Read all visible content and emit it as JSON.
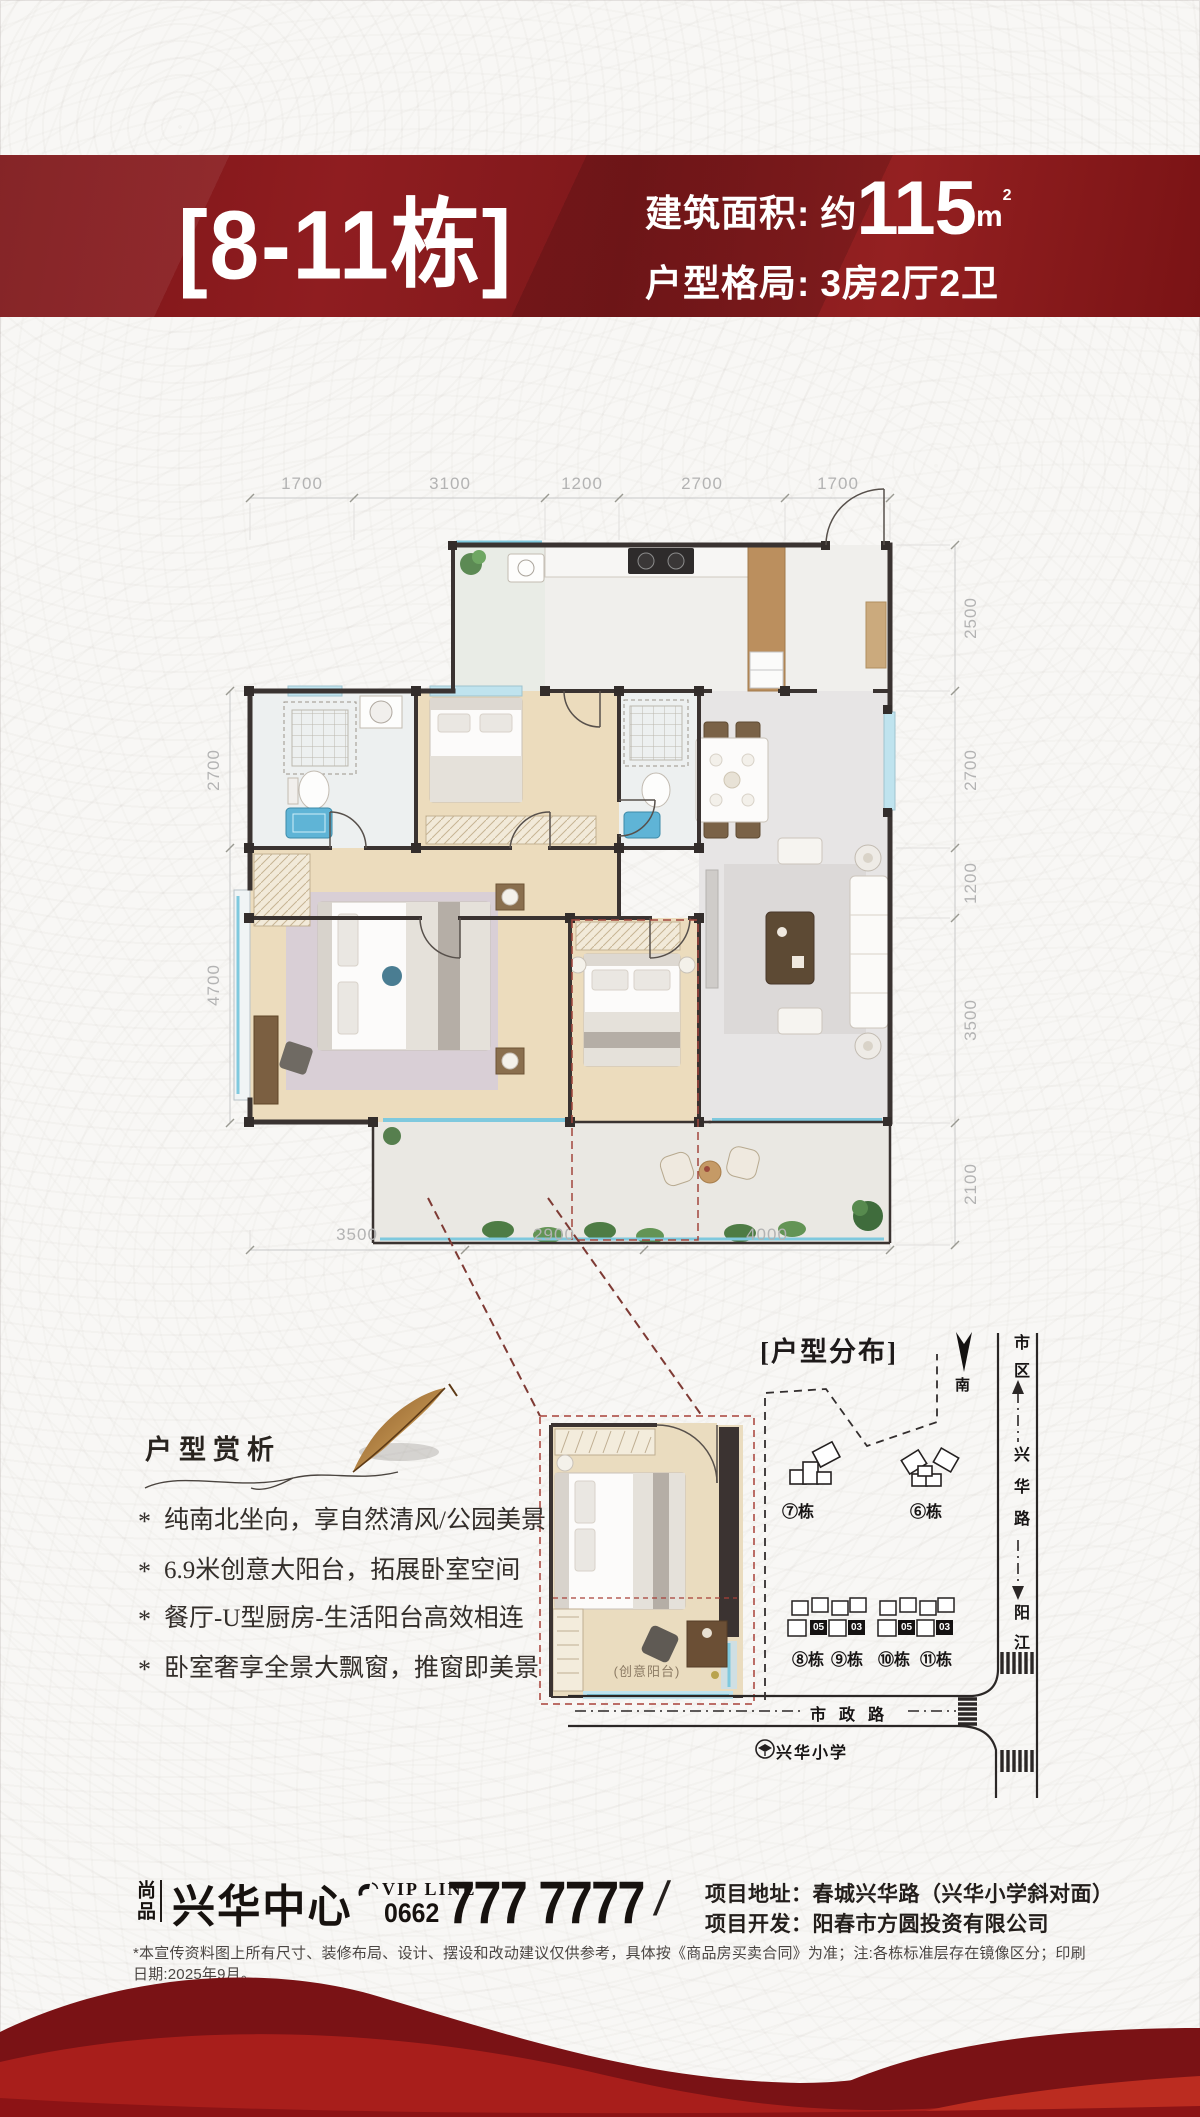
{
  "header": {
    "building_title": "[8-11栋]",
    "area_label": "建筑面积:",
    "area_approx": "约",
    "area_value": "115",
    "area_unit": "m",
    "area_unit_sup": "2",
    "layout_label": "户型格局:",
    "layout_value": "3房2厅2卫",
    "accent_color": "#8e1d21"
  },
  "floorplan": {
    "dims_top": [
      "1700",
      "3100",
      "1200",
      "2700",
      "1700"
    ],
    "dims_left": [
      "2700",
      "4700"
    ],
    "dims_right": [
      "2500",
      "2700",
      "1200",
      "3500",
      "2100"
    ],
    "dims_bottom": [
      "3500",
      "2900",
      "4000"
    ],
    "inset_label": "(创意阳台)"
  },
  "analysis": {
    "title": "户型赏析",
    "bullet_marker": "*",
    "bullets": [
      "纯南北坐向，享自然清风/公园美景",
      "6.9米创意大阳台，拓展卧室空间",
      "餐厅-U型厨房-生活阳台高效相连",
      "卧室奢享全景大飘窗，推窗即美景"
    ]
  },
  "distribution": {
    "title": "[户型分布]",
    "compass_label": "南",
    "buildings_top": [
      "⑦栋",
      "⑥栋"
    ],
    "buildings_bottom": [
      "⑧栋",
      "⑨栋",
      "⑩栋",
      "⑪栋"
    ],
    "unit_tags": [
      "05",
      "03",
      "05",
      "03"
    ],
    "road_right_top": "市区",
    "road_right_mid": "兴华路",
    "road_right_bottom": "阳江",
    "road_bottom": "市政路",
    "school": "兴华小学"
  },
  "footer": {
    "brand_tag": "尚品",
    "brand_name": "兴华中心",
    "vip_label": "VIP LINE",
    "phone_code": "0662",
    "phone_number": "777 7777",
    "divider": "/",
    "address_label": "项目地址：",
    "address_value": "春城兴华路（兴华小学斜对面）",
    "developer_label": "项目开发：",
    "developer_value": "阳春市方圆投资有限公司",
    "disclaimer": "*本宣传资料图上所有尺寸、装修布局、设计、摆设和改动建议仅供参考，具体按《商品房买卖合同》为准；注:各栋标准层存在镜像区分；印刷日期:2025年9月。"
  }
}
